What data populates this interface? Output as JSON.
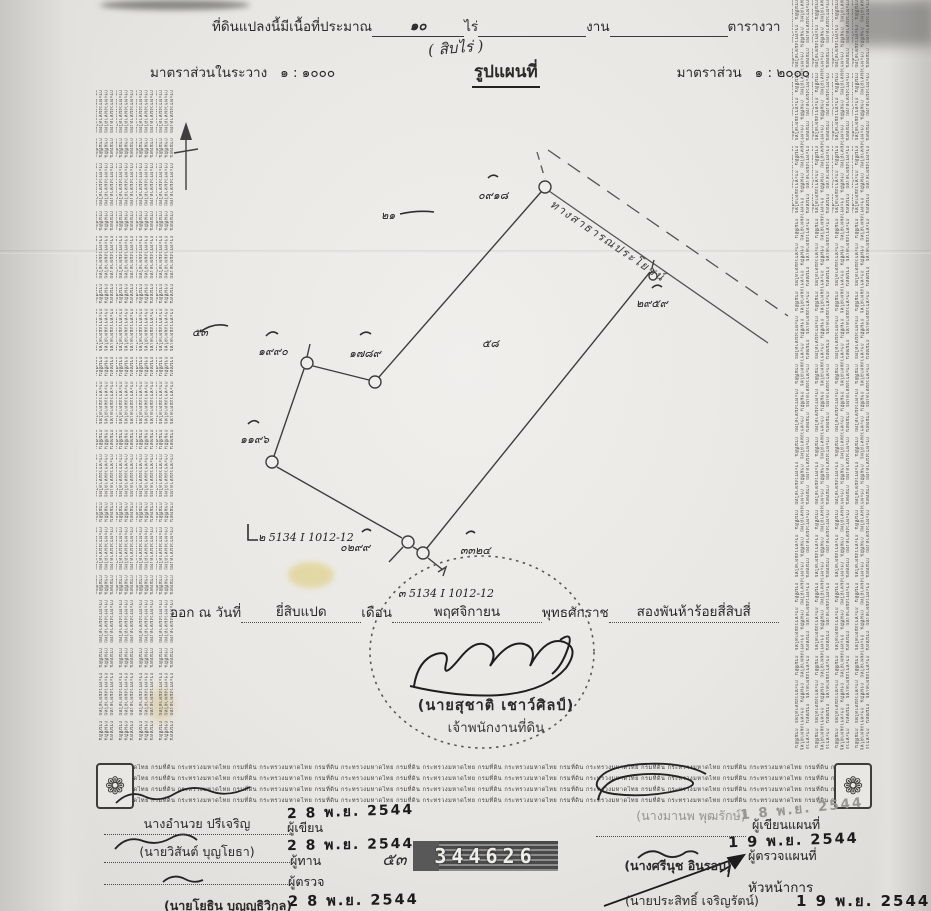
{
  "header": {
    "area_prefix": "ที่ดินแปลงนี้มีเนื้อที่ประมาณ",
    "area_rai_value": "๑๐",
    "unit_rai": "ไร่",
    "unit_ngan": "งาน",
    "unit_wa": "ตารางวา",
    "area_handwritten": "( สิบไร่ )",
    "scale_left_label": "มาตราส่วนในระวาง",
    "scale_left_value": "๑ : ๑๐๐๐",
    "map_title": "รูปแผนที่",
    "scale_right_label": "มาตราส่วน",
    "scale_right_value": "๑ : ๒๐๐๐"
  },
  "security": {
    "pattern_text": "กระทรวงมหาดไทย กรมที่ดิน",
    "strip_text": "กระทรวงมหาดไทย กรมที่ดิน",
    "corner_ornament_glyph": "❁"
  },
  "map": {
    "road_label": "ทางสาธารณประโยชน์",
    "labels": [
      {
        "text": "๐๙๑๘",
        "x": 478,
        "y": 186
      },
      {
        "text": "๑๙๙๐",
        "x": 258,
        "y": 342
      },
      {
        "text": "๑๗๘๙",
        "x": 349,
        "y": 344
      },
      {
        "text": "๑๑๙๖",
        "x": 240,
        "y": 430
      },
      {
        "text": "๒๙๕๙",
        "x": 636,
        "y": 294
      },
      {
        "text": "๐๒๙๙",
        "x": 340,
        "y": 538
      },
      {
        "text": "๓๓๒๔",
        "x": 460,
        "y": 541
      },
      {
        "text": "๒๑",
        "x": 381,
        "y": 206
      },
      {
        "text": "๕๓",
        "x": 192,
        "y": 323
      },
      {
        "text": "๕๘",
        "x": 482,
        "y": 334
      },
      {
        "text": "๒ 5134 I 1012-12",
        "x": 258,
        "y": 528
      },
      {
        "text": "๓ 5134 I 1012-12",
        "x": 398,
        "y": 584
      }
    ]
  },
  "issue": {
    "prefix": "ออก ณ วันที่",
    "day": "ยี่สิบแปด",
    "month_label": "เดือน",
    "month": "พฤศจิกายน",
    "era_label": "พุทธศักราช",
    "year": "สองพันห้าร้อยสี่สิบสี่"
  },
  "officer": {
    "name": "(นายสุชาติ เชาว์ศิลป์)",
    "title": "เจ้าพนักงานที่ดิน"
  },
  "serial": {
    "number": "344626",
    "hand_note": "๕๓"
  },
  "signatures_left": {
    "row1": {
      "name": "นางอำนวย ปรีเจริญ",
      "role": "ผู้เขียน",
      "date": "2 8 พ.ย. 2544"
    },
    "row2": {
      "name": "(นายวิสันต์ บุญโยธา)",
      "role": "ผู้ทาน",
      "date": "2 8 พ.ย. 2544"
    },
    "row3": {
      "name": "(นายโยธิน บุญญธิวิกุล)",
      "role": "ผู้ตรวจ",
      "date": "2 8 พ.ย. 2544"
    }
  },
  "signatures_right": {
    "row1": {
      "name": "(นางมานพ พุฒรักษ์)",
      "role": "ผู้เขียนแผนที่",
      "date": "1 8 พ.ย. 2544"
    },
    "row2": {
      "name": "(นางศรีนุช อินรอบ)",
      "role": "ผู้ตรวจแผนที่",
      "date": "1 9 พ.ย. 2544"
    },
    "row3": {
      "name": "(นายประสิทธิ์ เจริญรัตน์)",
      "role": "หัวหน้าการ",
      "date": "1 9 พ.ย. 2544"
    }
  }
}
